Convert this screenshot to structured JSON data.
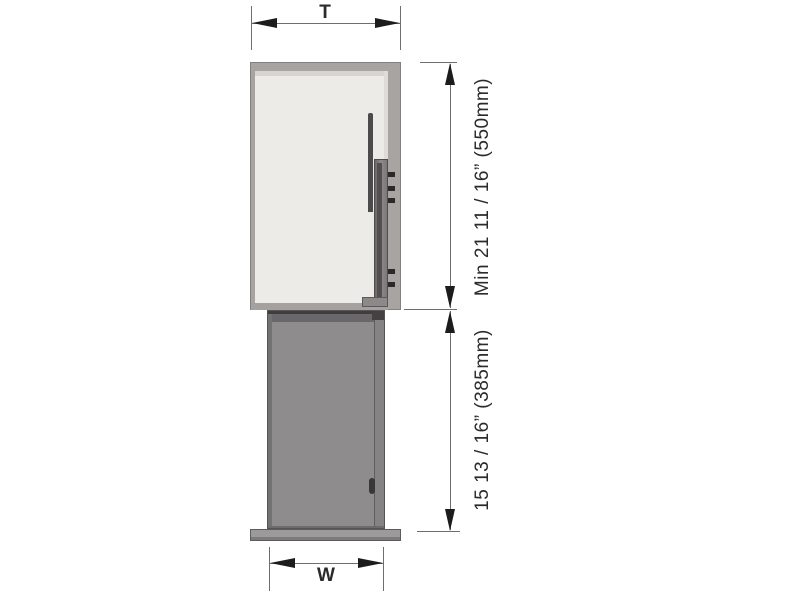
{
  "figure": {
    "type": "technical-dimension-diagram",
    "subject": "wall cabinet with pull-out unit, front elevation",
    "labels": {
      "top_width": "T",
      "bottom_width": "W",
      "upper_height": "Min 21 11 / 16” (550mm)",
      "lower_height": "15 13 / 16” (385mm)"
    },
    "colors": {
      "background": "#ffffff",
      "dim_line": "#6e6e6e",
      "arrow": "#1c1c1c",
      "text": "#2b2b2b",
      "cabinet_frame": "#a8a4a1",
      "cabinet_interior": "#edebe8",
      "pullout_body": "#8f8c8e",
      "base_plate": "#9d9a9b",
      "hardware_dark": "#4c4a4b"
    }
  }
}
